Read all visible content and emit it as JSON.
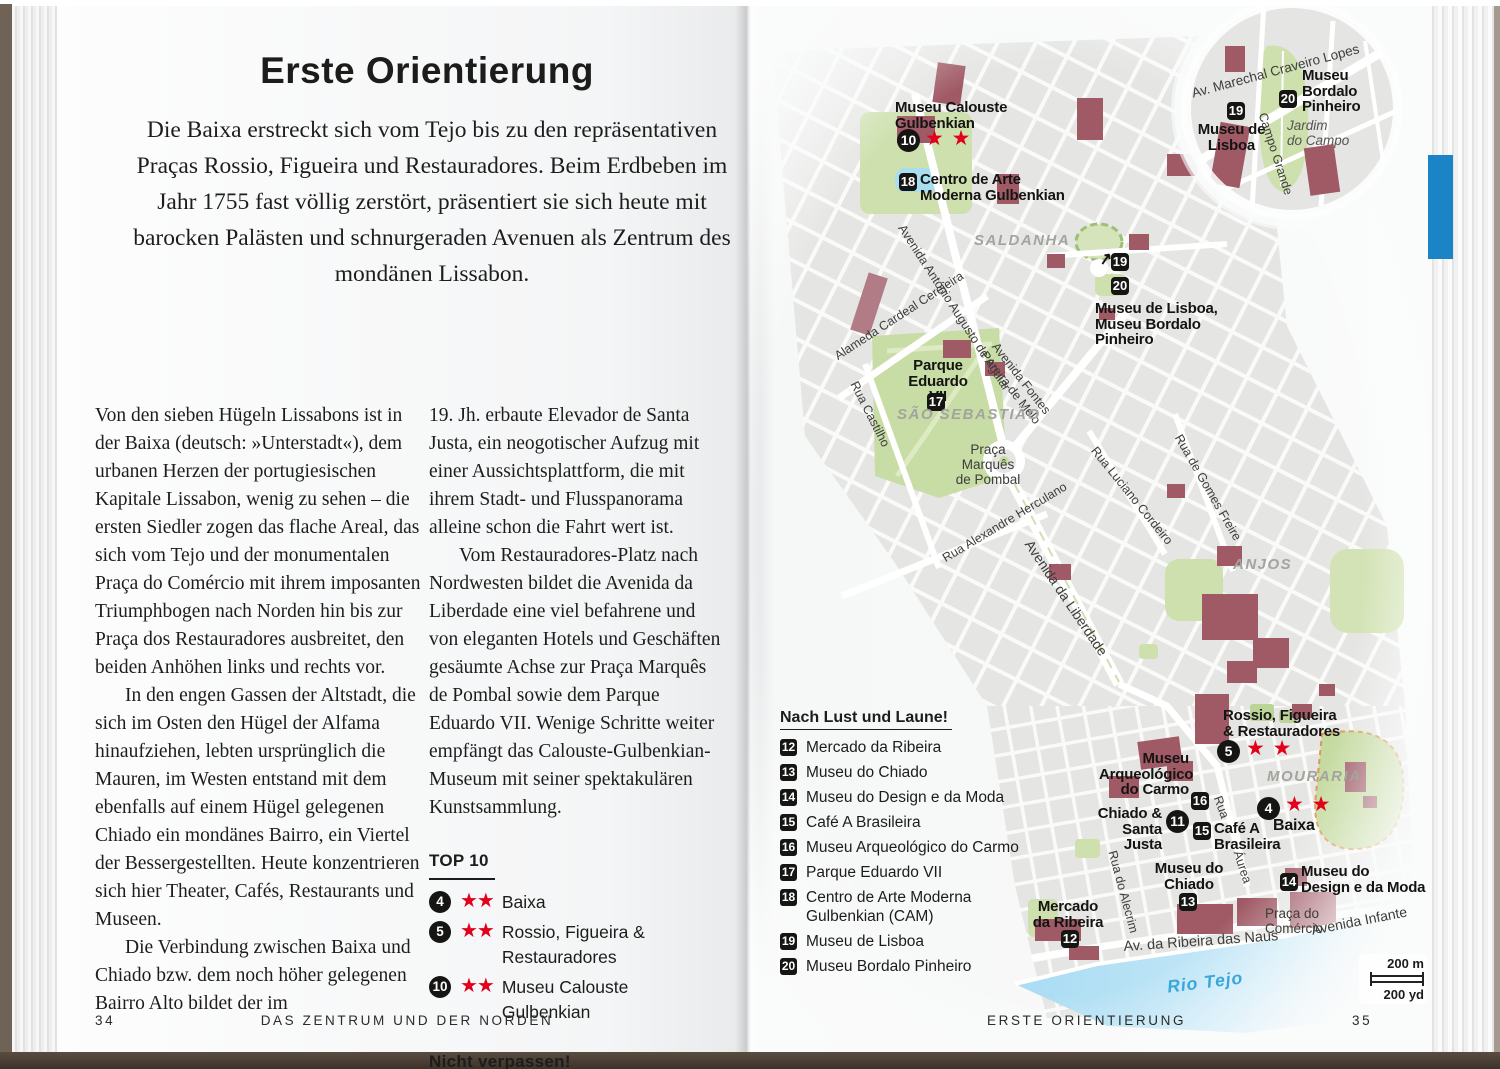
{
  "colors": {
    "accent_tab": "#1b84c6",
    "star_red": "#e2001a",
    "water_text": "#39a7da"
  },
  "left_page": {
    "title": "Erste Orientierung",
    "intro": "Die Baixa erstreckt sich vom Tejo bis zu den repräsentativen Praças Rossio, Figueira und Restauradores. Beim Erdbeben im Jahr 1755 fast völlig zerstört, präsentiert sie sich heute mit barocken Palästen und schnurgeraden Avenuen als Zentrum des mondänen Lissabon.",
    "col1_p1": "Von den sieben Hügeln Lissabons ist in der Baixa (deutsch: »Unterstadt«), dem urbanen Herzen der portugiesischen Kapitale Lissabon, wenig zu sehen – die ersten Siedler zogen das flache Areal, das sich vom Tejo und der monumentalen Praça do Comércio mit ihrem imposanten Triumphbogen nach Norden hin bis zur Praça dos Restauradores ausbreitet, den beiden Anhöhen links und rechts vor.",
    "col1_p2": "In den engen Gassen der Altstadt, die sich im Osten den Hügel der Alfama hinaufziehen, lebten ursprünglich die Mauren, im Westen entstand mit dem ebenfalls auf einem Hügel gelegenen Chiado ein mondänes Bairro, ein Viertel der Bessergestellten. Heute konzentrieren sich hier Theater, Cafés, Restaurants und Museen.",
    "col1_p3": "Die Verbindung zwischen Baixa und Chiado bzw. dem noch höher gelegenen Bairro Alto bildet der im",
    "col2_p1": "19. Jh. erbaute Elevador de Santa Justa, ein neogotischer Aufzug mit einer Aussichtsplattform, die mit ihrem Stadt- und Flusspanorama alleine schon die Fahrt wert ist.",
    "col2_p2": "Vom Restauradores-Platz nach Nordwesten bildet die Avenida da Liberdade eine viel befahrene und von eleganten Hotels und Geschäften gesäumte Achse zur Praça Marquês de Pombal sowie dem Parque Eduardo VII. Wenige Schritte weiter empfängt das Calouste-Gulbenkian-Museum mit seiner spektakulären Kunstsammlung.",
    "top10": {
      "heading": "TOP 10",
      "items": [
        {
          "num": "4",
          "stars": "★★",
          "label": "Baixa"
        },
        {
          "num": "5",
          "stars": "★★",
          "label": "Rossio, Figueira &\nRestauradores"
        },
        {
          "num": "10",
          "stars": "★★",
          "label": "Museu Calouste\nGulbenkian"
        }
      ]
    },
    "dont_miss": {
      "heading": "Nicht verpassen!",
      "items": [
        {
          "num": "11",
          "label": "Chiado & Santa Justa"
        }
      ]
    },
    "footer": {
      "page_number": "34",
      "chapter": "DAS ZENTRUM UND DER NORDEN"
    }
  },
  "right_page": {
    "footer": {
      "section": "ERSTE ORIENTIERUNG",
      "page_number": "35"
    },
    "legend": {
      "heading": "Nach Lust und Laune!",
      "items": [
        {
          "num": "12",
          "label": "Mercado da Ribeira"
        },
        {
          "num": "13",
          "label": "Museu do Chiado"
        },
        {
          "num": "14",
          "label": "Museu do Design e da Moda"
        },
        {
          "num": "15",
          "label": "Café A Brasileira"
        },
        {
          "num": "16",
          "label": "Museu Arqueológico do Carmo"
        },
        {
          "num": "17",
          "label": "Parque Eduardo VII"
        },
        {
          "num": "18",
          "label": "Centro de Arte Moderna\nGulbenkian (CAM)"
        },
        {
          "num": "19",
          "label": "Museu de Lisboa"
        },
        {
          "num": "20",
          "label": "Museu Bordalo Pinheiro"
        }
      ]
    },
    "map": {
      "arrow": "↗",
      "sights": {
        "calouste": {
          "num": "10",
          "stars": "★ ★",
          "label": "Museu Calouste\nGulbenkian"
        },
        "cam": {
          "num": "18",
          "label": "Centro de Arte\nModerna Gulbenkian"
        },
        "lisboa_bordalo": {
          "num1": "19",
          "num2": "20",
          "label": "Museu de Lisboa,\nMuseu Bordalo\nPinheiro"
        },
        "eduardo": {
          "num": "17",
          "label": "Parque\nEduardo VII"
        },
        "rossio": {
          "num": "5",
          "stars": "★ ★",
          "label": "Rossio, Figueira\n& Restauradores"
        },
        "carmo": {
          "num": "16",
          "label": "Museu\nArqueológico\ndo Carmo"
        },
        "chiado_justa": {
          "num": "11",
          "label": "Chiado &\nSanta Justa"
        },
        "brasileira": {
          "num": "15",
          "label": "Café A\nBrasileira"
        },
        "baixa": {
          "num": "4",
          "stars": "★ ★",
          "label": "Baixa"
        },
        "museu_chiado": {
          "num": "13",
          "label": "Museu do\nChiado"
        },
        "ribeira": {
          "num": "12",
          "label": "Mercado\nda Ribeira"
        },
        "design": {
          "num": "14",
          "label": "Museu do\nDesign e da Moda"
        },
        "inset_lisboa": {
          "num": "19",
          "label": "Museu de\nLisboa"
        },
        "inset_bordalo": {
          "num": "20",
          "label": "Museu\nBordalo\nPinheiro"
        }
      },
      "districts": {
        "saldanha": "SALDANHA",
        "sao_sebastiao": "SÃO SEBASTIÃO",
        "anjos": "ANJOS",
        "mouraria": "MOURARIA"
      },
      "streets": {
        "marechal": "Av. Marechal Craveiro Lopes",
        "campo_grande": "Campo Grande",
        "aguiar": "Avenida António Augusto de Aguiar",
        "alameda": "Alameda Cardeal Cerejeira",
        "castilho": "Rua Castilho",
        "fontes": "Avenida Fontes\nPereira de Melo",
        "herculano": "Rua Alexandre Herculano",
        "liberdade": "Avenida da Liberdade",
        "luciano": "Rua Luciano Cordeiro",
        "gomes": "Rua de Gomes Freire",
        "rua": "Rua",
        "aurea": "Áurea",
        "alecrim": "Rua do Alecrim",
        "naus": "Av. da Ribeira das Naus",
        "infante": "Avenida Infante"
      },
      "places": {
        "pombal": "Praça Marquês\nde Pombal",
        "comercio": "Praça do\nComércio",
        "jardim": "Jardim\ndo Campo"
      },
      "water": "Rio Tejo",
      "scale": {
        "metric": "200 m",
        "imperial": "200 yd"
      }
    }
  }
}
